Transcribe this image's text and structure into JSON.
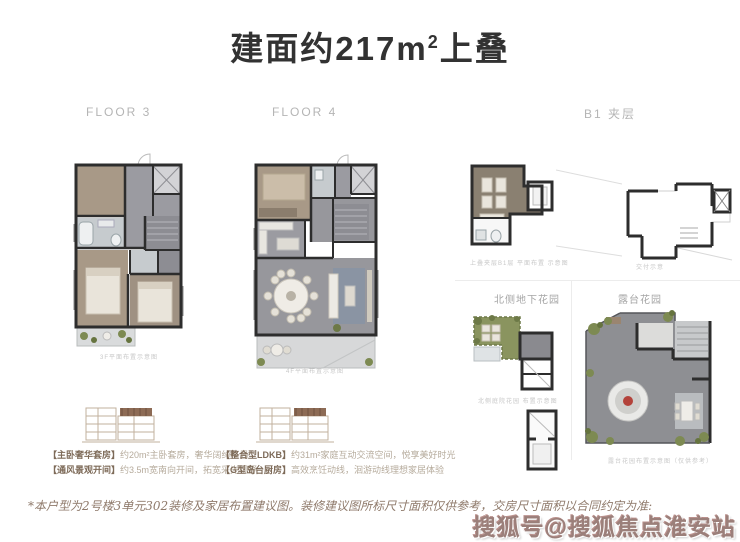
{
  "title": {
    "prefix": "建面约217m",
    "sup": "2",
    "suffix": "上叠"
  },
  "sections": {
    "floor3": {
      "label": "FLOOR 3",
      "caption": "3F平面布置示意图"
    },
    "floor4": {
      "label": "FLOOR 4",
      "caption": "4F平面布置示意图"
    },
    "b1": {
      "label": "B1 夹层",
      "left_caption": "上叠夹层B1层 平面布置 示意图",
      "right_caption": "交付示意",
      "garden_label": "北侧地下花园",
      "garden_caption": "北侧庭院花园 布置示意图",
      "terrace_label": "露台花园",
      "terrace_caption": "露台花园布置示意图（仅供参考）"
    }
  },
  "legend": {
    "left": [
      {
        "tag": "【主卧奢华套房】",
        "desc": "约20m²主卧套房，奢华阔绰格局"
      },
      {
        "tag": "【通风景观开间】",
        "desc": "约3.5m宽南向开间，拓宽采光视野"
      }
    ],
    "right": [
      {
        "tag": "【整合型LDKB】",
        "desc": "约31m²家庭互动交流空间，悦享美好时光"
      },
      {
        "tag": "【G型岛台厨房】",
        "desc": "高效烹饪动线，洄游动线理想家居体验"
      }
    ]
  },
  "disclaimer": "*本户型为2号楼3单元302装修及家居布置建议图。装修建议图所标尺寸面积仅供参考，交房尺寸面积以合同约定为准:",
  "watermark": "搜狐号@搜狐焦点淮安站",
  "colors": {
    "wall": "#2d2d2d",
    "wood_floor": "#a89987",
    "gray_floor": "#97979c",
    "bath": "#c6cbce",
    "terrace": "#d8dadb",
    "garden_green": "#8a945f",
    "watermark_red": "#9b7f7a"
  }
}
